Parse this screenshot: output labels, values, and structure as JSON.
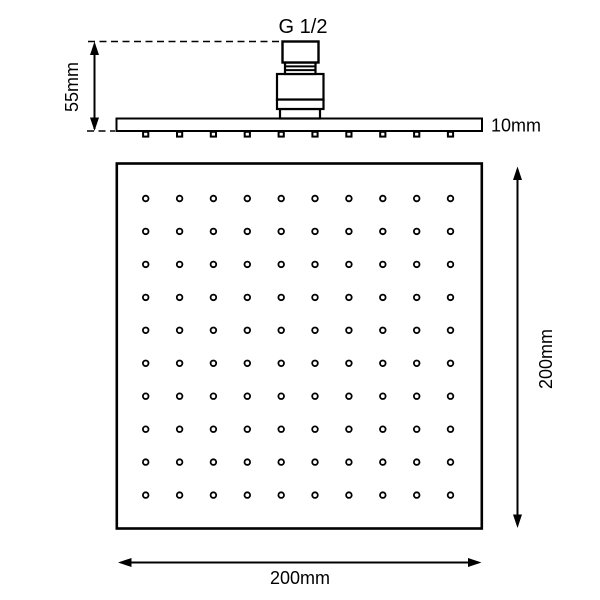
{
  "drawing": {
    "connector_thread_label": "G 1/2",
    "dimensions": {
      "side_height": "55mm",
      "plate_thickness": "10mm",
      "face_width": "200mm",
      "face_height": "200mm"
    },
    "nozzle_grid": {
      "rows": 10,
      "cols": 10,
      "side_profile_nozzles": 10
    },
    "colors": {
      "line": "#000000",
      "background": "#ffffff"
    }
  }
}
